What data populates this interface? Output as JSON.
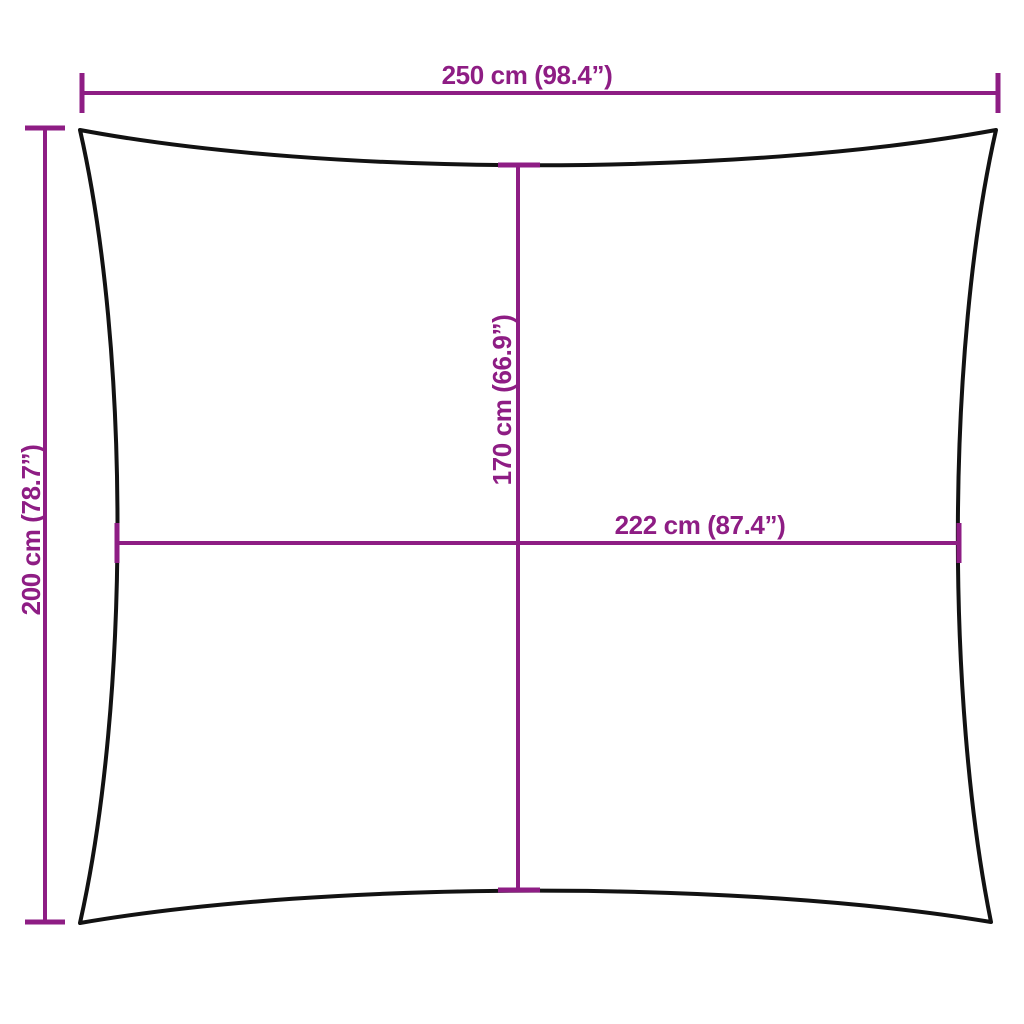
{
  "labels": {
    "top_width": "250 cm (98.4”)",
    "left_height": "200 cm (78.7”)",
    "inner_height": "170 cm (66.9”)",
    "inner_width": "222 cm (87.4”)"
  },
  "colors": {
    "accent": "#8E1D84",
    "outline": "#121212",
    "background": "#FFFFFF"
  }
}
